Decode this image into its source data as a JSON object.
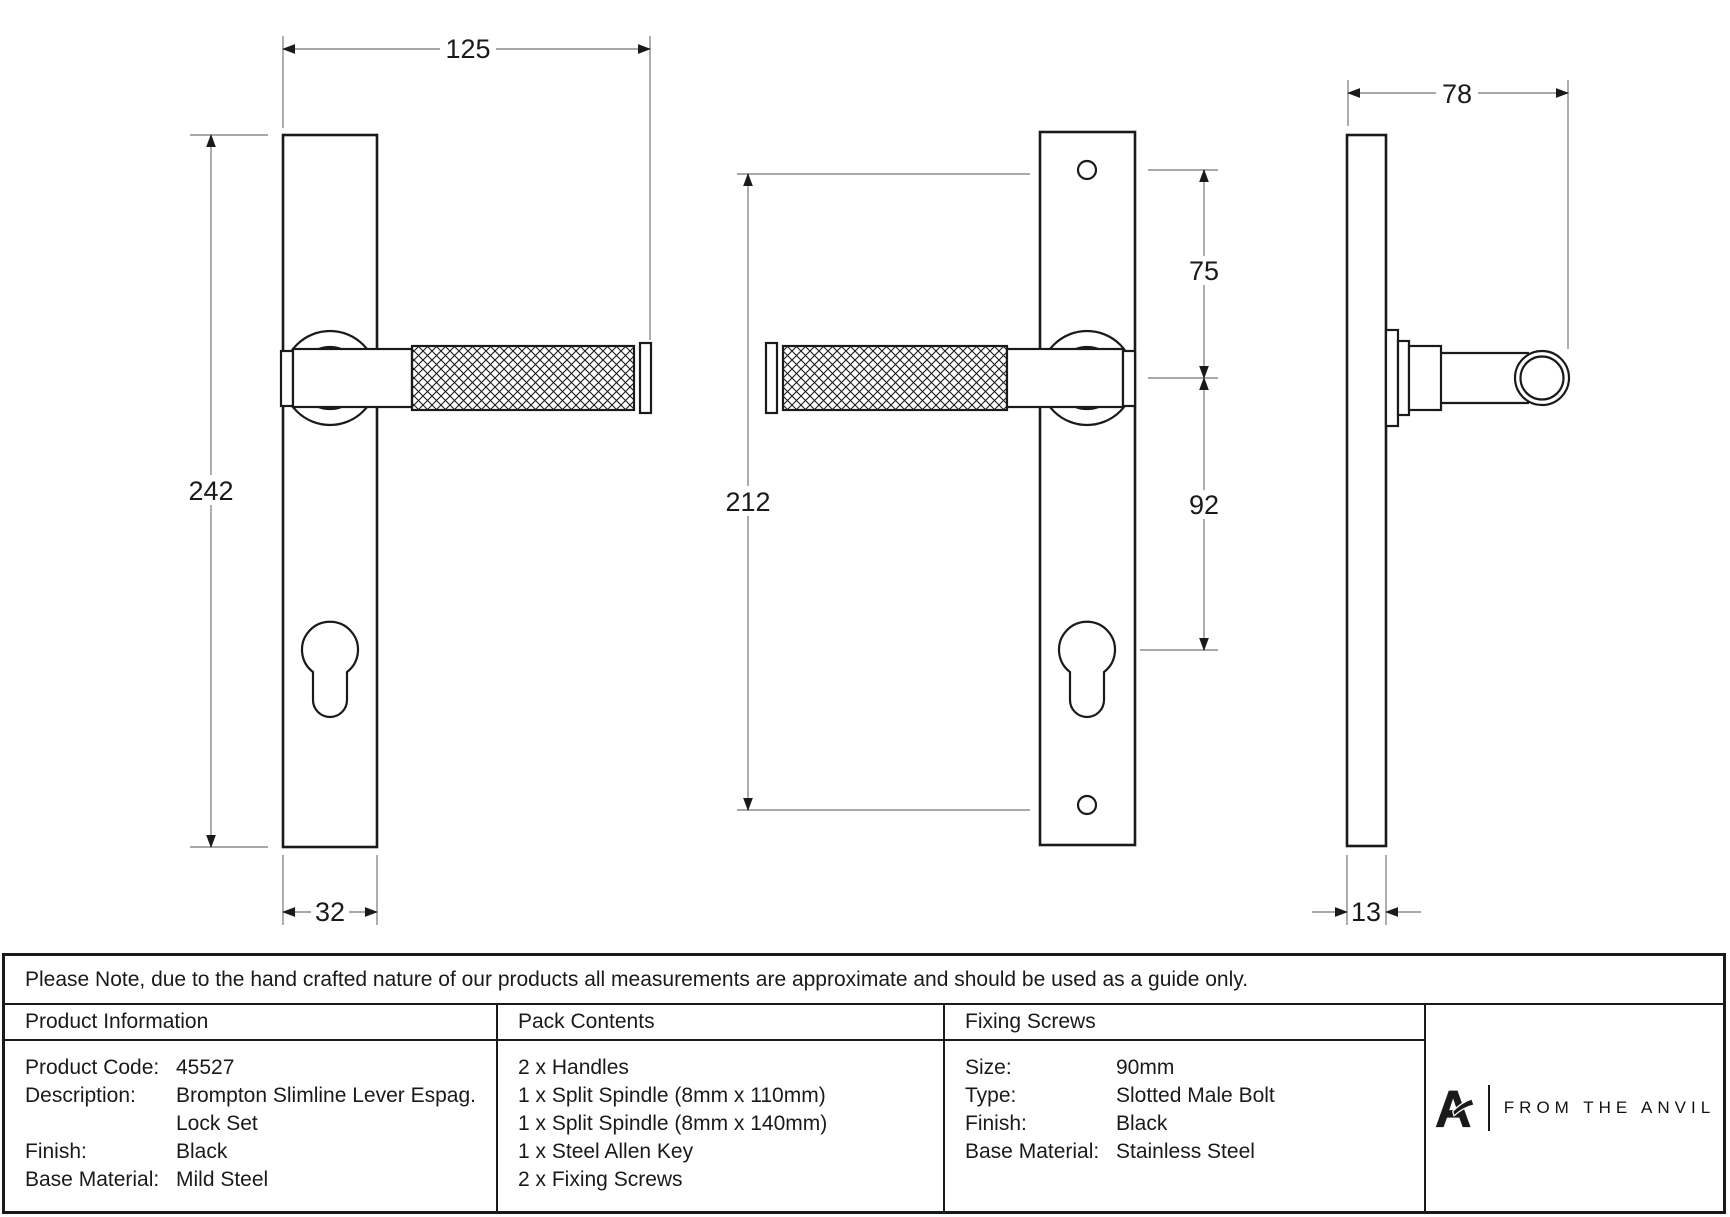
{
  "drawing": {
    "dims": {
      "overall_width": "125",
      "plate_height": "242",
      "plate_width": "32",
      "screw_centres": "212",
      "top_to_handle": "75",
      "handle_to_cylinder": "92",
      "overall_depth": "78",
      "plate_thickness": "13"
    }
  },
  "note": {
    "text": "Please Note, due to the hand crafted nature of our products all measurements are approximate and should be used as a guide only."
  },
  "table": {
    "product_information": {
      "title": "Product Information",
      "rows": [
        {
          "label": "Product Code:",
          "value": "45527"
        },
        {
          "label": "Description:",
          "value": "Brompton Slimline Lever Espag."
        },
        {
          "label": "",
          "value": "Lock Set"
        },
        {
          "label": "Finish:",
          "value": "Black"
        },
        {
          "label": "Base Material:",
          "value": "Mild Steel"
        }
      ]
    },
    "pack_contents": {
      "title": "Pack Contents",
      "items": [
        "2 x Handles",
        "1 x Split Spindle (8mm x 110mm)",
        "1 x Split Spindle (8mm x 140mm)",
        "1 x Steel Allen Key",
        "2 x Fixing Screws"
      ]
    },
    "fixing_screws": {
      "title": "Fixing Screws",
      "rows": [
        {
          "label": "Size:",
          "value": "90mm"
        },
        {
          "label": "Type:",
          "value": "Slotted Male Bolt"
        },
        {
          "label": "Finish:",
          "value": "Black"
        },
        {
          "label": "Base Material:",
          "value": "Stainless Steel"
        }
      ]
    },
    "brand": {
      "name": "FROM THE ANVIL"
    }
  },
  "colors": {
    "line": "#1a1a1a",
    "dim_line": "#8c8c8c",
    "background": "#ffffff"
  }
}
